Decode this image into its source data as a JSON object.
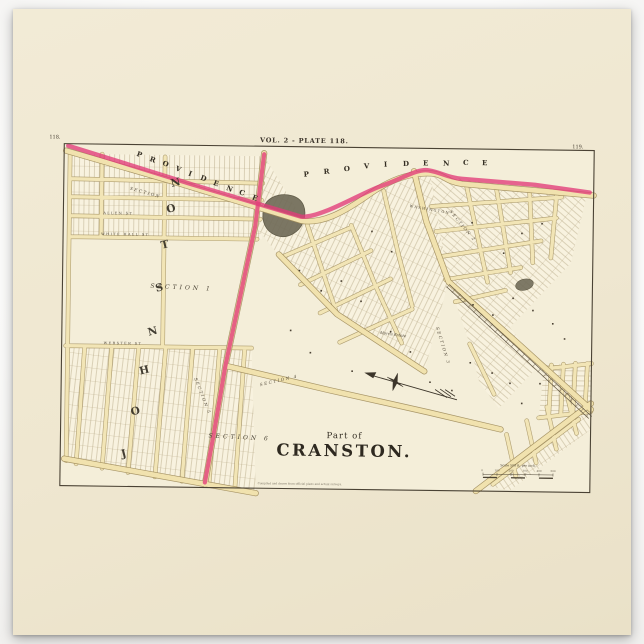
{
  "poster": {
    "plate_label": "VOL. 2 - PLATE 118.",
    "page_left": "118.",
    "page_right": "119.",
    "title_part": "Part of",
    "title_main": "CRANSTON.",
    "scale_label": "Scale 500 ft. per inch.",
    "scale_ticks": [
      "0",
      "100",
      "200",
      "300",
      "400",
      "500"
    ],
    "fine_print": "Compiled and drawn from official plans and actual surveys."
  },
  "boundaries": {
    "providence": "PROVIDENCE",
    "johnston": "JOHNSTON"
  },
  "sections": {
    "s1": "SECTION 1",
    "s2": "SECTION 2",
    "s3": "SECTION 3",
    "s4": "SECTION 4",
    "s5": "SECTION 5",
    "s6": "SECTION 6",
    "s7": "SECTION"
  },
  "streets": {
    "white_hall": "WHITE HALL ST",
    "allen": "ALLEN ST",
    "webster": "WEBSTER ST",
    "washington": "WASHINGTON",
    "morris": "Morris Estate"
  },
  "colors": {
    "boundary_highlight": "#e23b78",
    "road_fill": "#f1e2ae",
    "paper": "#efe7d0",
    "ink": "#3f382b"
  }
}
